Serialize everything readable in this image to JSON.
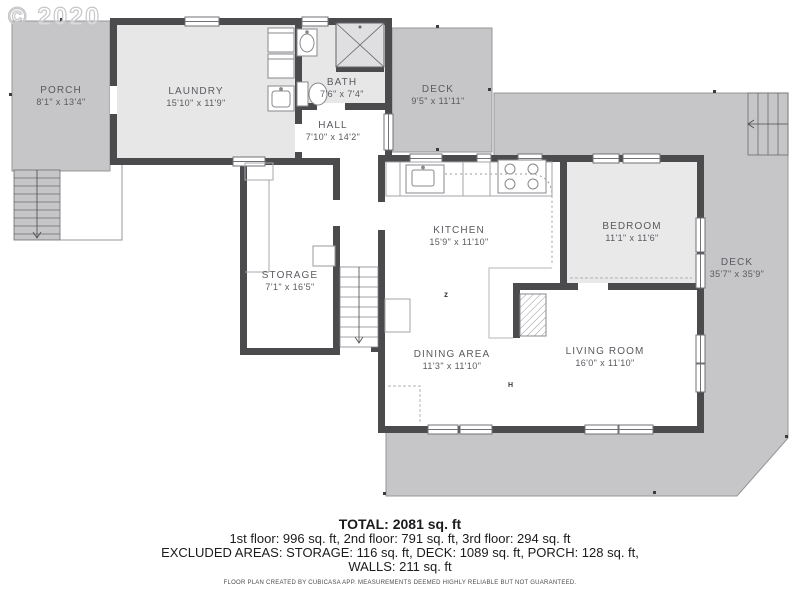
{
  "watermark": "© 2020",
  "rooms": {
    "porch": {
      "name": "PORCH",
      "dims": "8'1\" x 13'4\""
    },
    "laundry": {
      "name": "LAUNDRY",
      "dims": "15'10\" x 11'9\""
    },
    "bath": {
      "name": "BATH",
      "dims": "7'6\" x 7'4\""
    },
    "deck_top": {
      "name": "DECK",
      "dims": "9'5\" x 11'11\""
    },
    "hall": {
      "name": "HALL",
      "dims": "7'10\" x 14'2\""
    },
    "storage": {
      "name": "STORAGE",
      "dims": "7'1\" x 16'5\""
    },
    "kitchen": {
      "name": "KITCHEN",
      "dims": "15'9\" x 11'10\""
    },
    "bedroom": {
      "name": "BEDROOM",
      "dims": "11'1\" x 11'6\""
    },
    "deck_right": {
      "name": "DECK",
      "dims": "35'7\" x 35'9\""
    },
    "dining": {
      "name": "DINING AREA",
      "dims": "11'3\" x 11'10\""
    },
    "living": {
      "name": "LIVING ROOM",
      "dims": "16'0\" x 11'10\""
    }
  },
  "markers": {
    "m1": "z",
    "m2": "H"
  },
  "colors": {
    "wall": "#4b4b4e",
    "deck": "#c6c6c8",
    "room_gray": "#e7e7e8",
    "label": "#5a5a5f"
  },
  "summary": {
    "total": "TOTAL: 2081 sq. ft",
    "floors": "1st floor: 996 sq. ft, 2nd floor: 791 sq. ft, 3rd floor: 294 sq. ft",
    "excluded": "EXCLUDED AREAS: STORAGE: 116 sq. ft, DECK: 1089 sq. ft, PORCH: 128 sq. ft,",
    "walls": "WALLS: 211 sq. ft",
    "disclaimer": "FLOOR PLAN CREATED BY CUBICASA APP. MEASUREMENTS DEEMED HIGHLY RELIABLE BUT NOT GUARANTEED."
  }
}
